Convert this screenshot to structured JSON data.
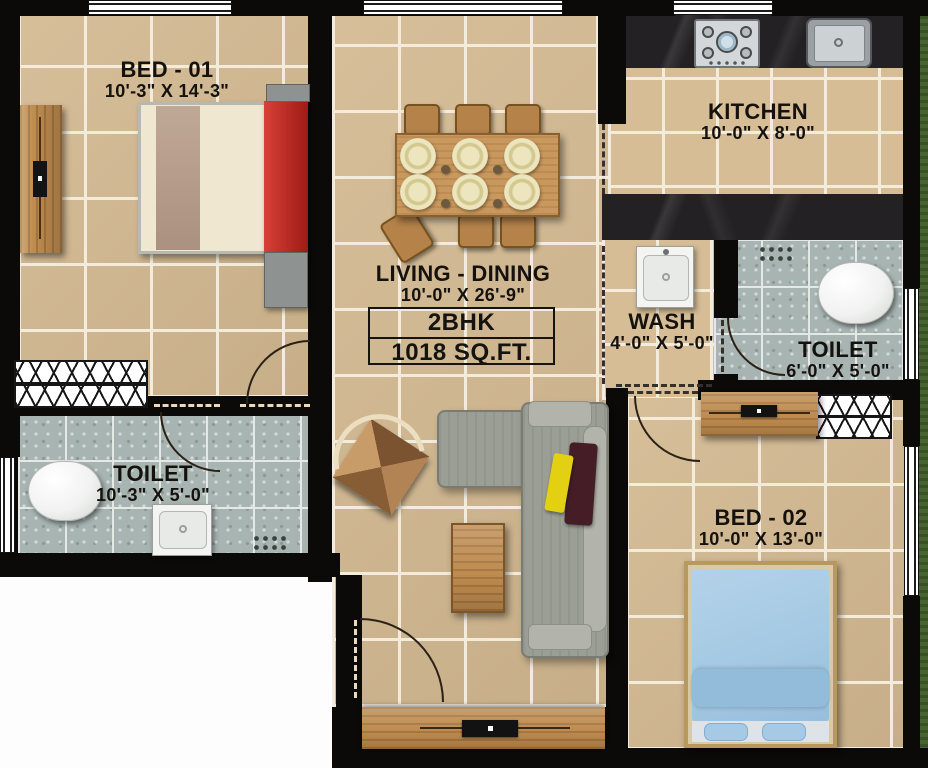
{
  "unit": {
    "type": "2BHK",
    "area": "1018 SQ.FT."
  },
  "rooms": {
    "bed1": {
      "name": "BED - 01",
      "dims": "10'-3\" X 14'-3\""
    },
    "kitchen": {
      "name": "KITCHEN",
      "dims": "10'-0\" X 8'-0\""
    },
    "living": {
      "name": "LIVING - DINING",
      "dims": "10'-0\" X 26'-9\""
    },
    "wash": {
      "name": "WASH",
      "dims": "4'-0\" X 5'-0\""
    },
    "toilet_right": {
      "name": "TOILET",
      "dims": "6'-0\" X 5'-0\""
    },
    "toilet_left": {
      "name": "TOILET",
      "dims": "10'-3\" X 5'-0\""
    },
    "bed2": {
      "name": "BED - 02",
      "dims": "10'-0\" X 13'-0\""
    }
  },
  "colors": {
    "wall": "#0b0a09",
    "tile_beige": "#d3b991",
    "tile_grout": "#f3ecdd",
    "tile_bath": "#a7b4b1",
    "counter_marble": "#242124",
    "wood": "#c08d50",
    "sofa_gray": "#9b9e95",
    "bed1_headboard_red": "#c1271f",
    "bed2_blanket_blue": "#a9cce6",
    "pillow_yellow": "#e3d012",
    "pillow_maroon": "#441d27",
    "lawn_green": "#47632f",
    "outside_white": "#ffffff"
  }
}
